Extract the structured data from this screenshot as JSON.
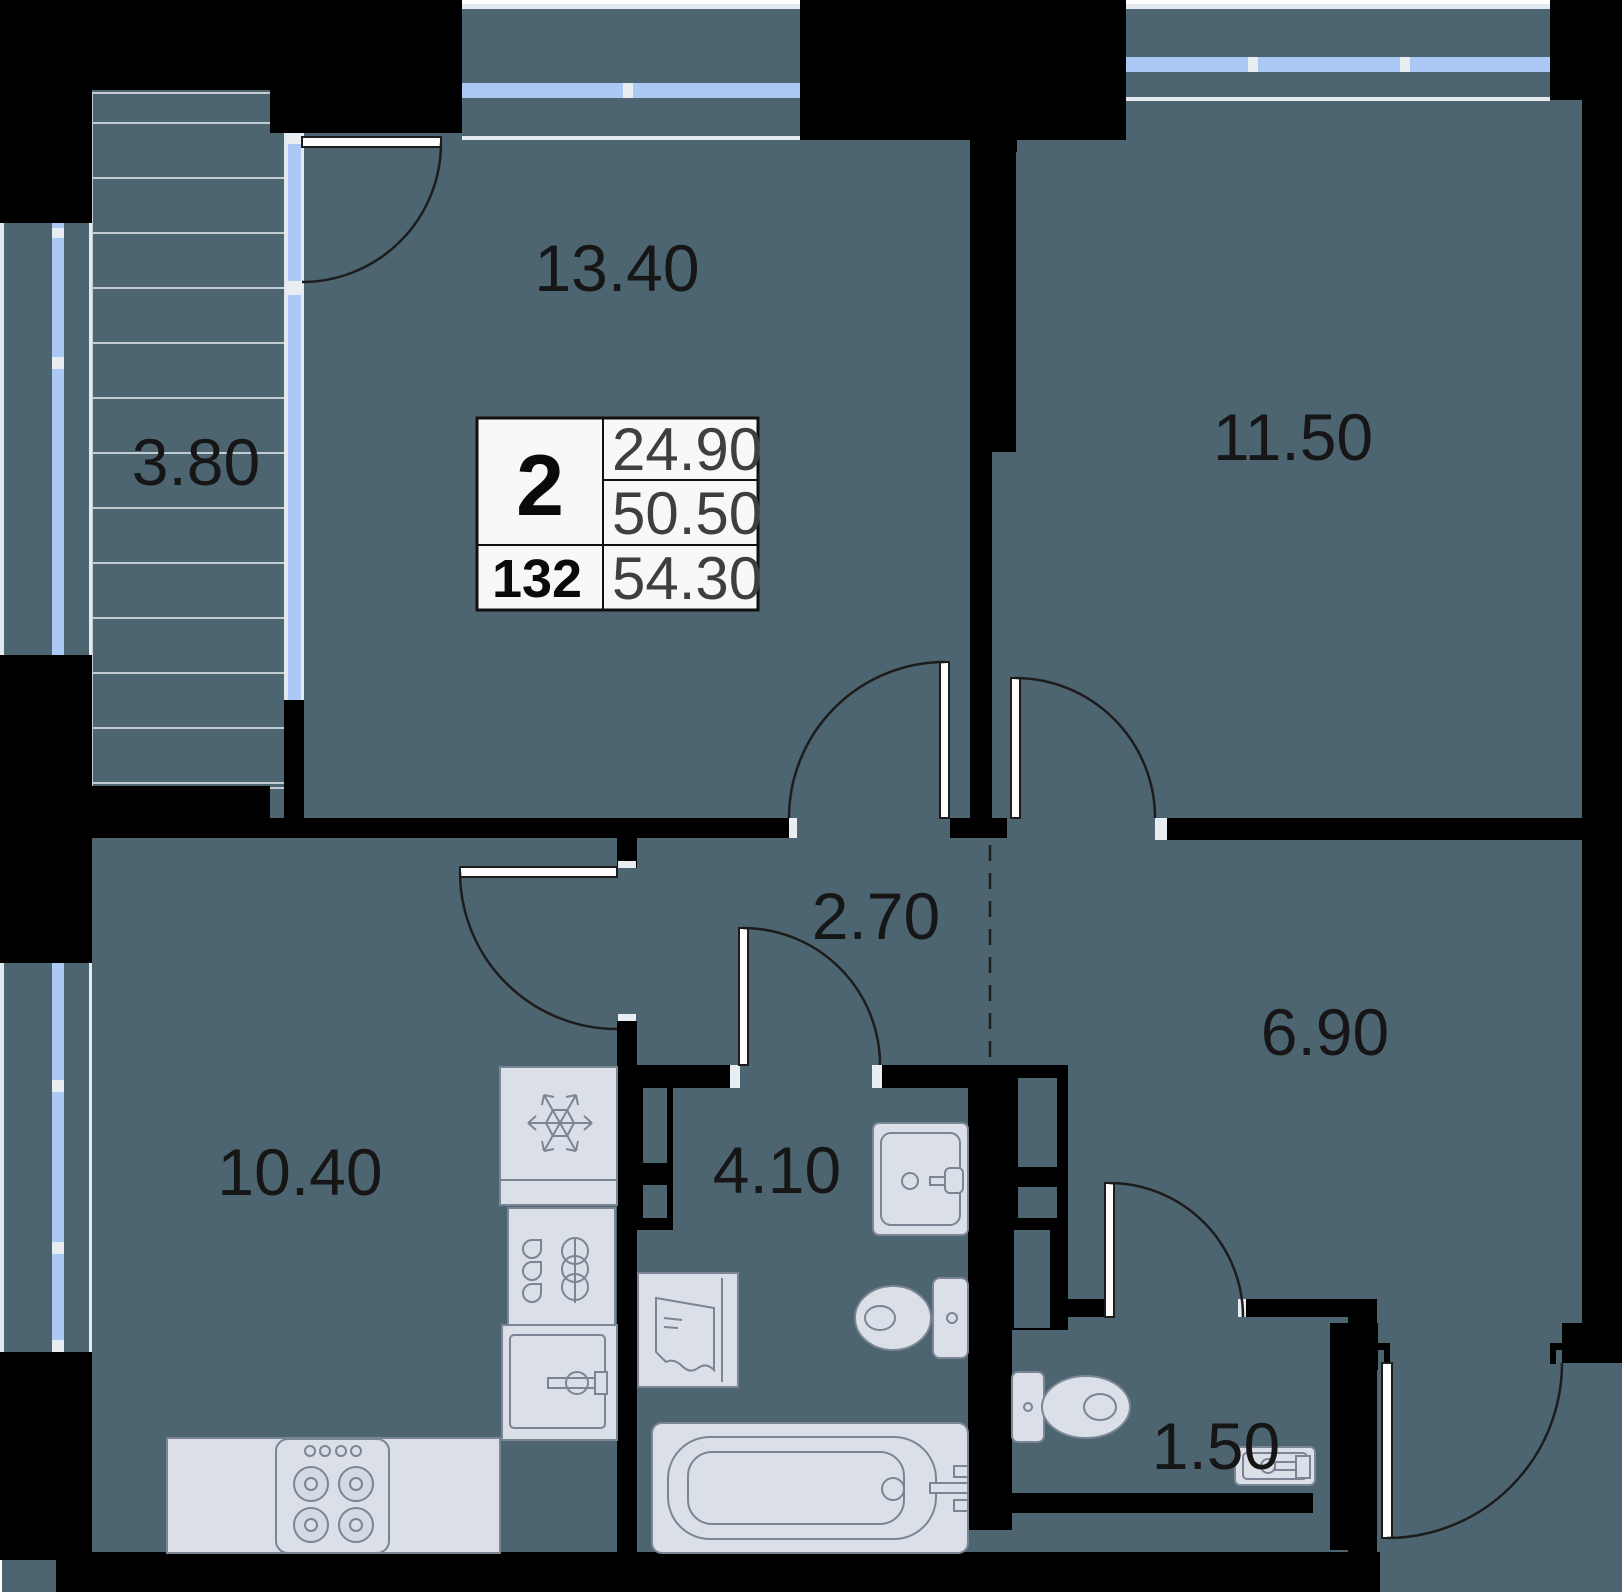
{
  "plan": {
    "type": "apartment-floor-plan",
    "info_table": {
      "rooms_count": "2",
      "unit_number": "132",
      "living_area": "24.90",
      "area_without_balcony": "50.50",
      "total_area": "54.30"
    },
    "rooms": [
      {
        "name": "living-room",
        "area_label": "13.40"
      },
      {
        "name": "bedroom",
        "area_label": "11.50"
      },
      {
        "name": "balcony",
        "area_label": "3.80"
      },
      {
        "name": "corridor",
        "area_label": "2.70"
      },
      {
        "name": "hallway",
        "area_label": "6.90"
      },
      {
        "name": "kitchen",
        "area_label": "10.40"
      },
      {
        "name": "bathroom",
        "area_label": "4.10"
      },
      {
        "name": "wc",
        "area_label": "1.50"
      }
    ],
    "fixtures": [
      "refrigerator",
      "kitchen-cabinet",
      "kitchen-sink",
      "stove",
      "counter",
      "bathroom-sink",
      "toilet",
      "washing-machine",
      "bathtub",
      "wc-toilet",
      "wc-sink"
    ],
    "colors": {
      "wall": "#000000",
      "floor": "#4d6570",
      "fixture_fill": "#dbe0e8",
      "fixture_stroke": "#7b8593",
      "window_glass": "#abc9f4",
      "label_text": "#161616",
      "table_background": "#f8f8f8",
      "table_value_text": "#3f3f3f"
    }
  }
}
